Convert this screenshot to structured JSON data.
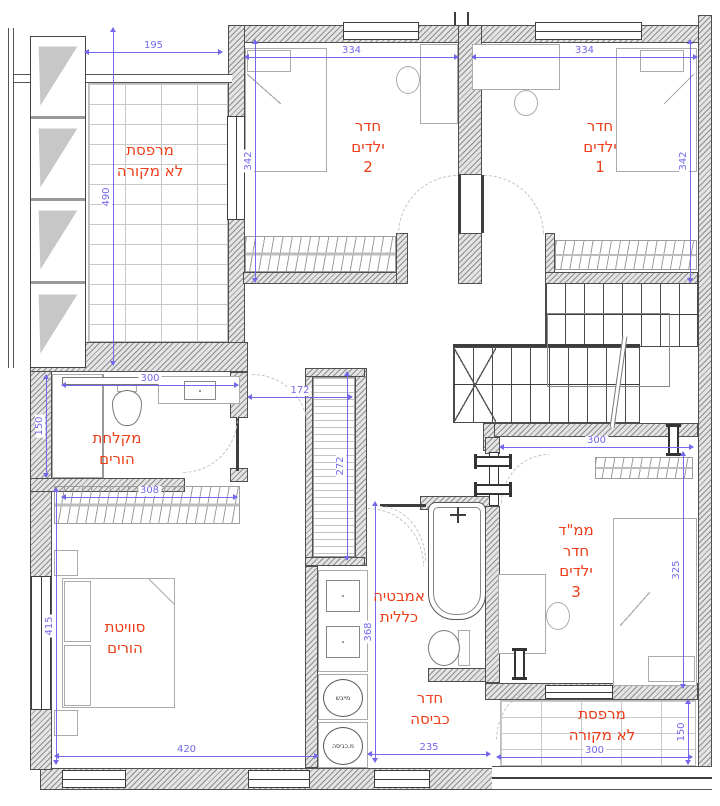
{
  "plan": {
    "title_note": "floor plan",
    "rooms": {
      "balcony_top_left": {
        "label": "מרפסת\nלא מקורה",
        "width": "195",
        "height": "490"
      },
      "kids_room_2": {
        "label": "חדר\nילדים\n2",
        "width": "334",
        "height": "342"
      },
      "kids_room_1": {
        "label": "חדר\nילדים\n1",
        "width": "334",
        "height": "342"
      },
      "parents_shower": {
        "label": "מקלחת\nהורים",
        "width": "300",
        "height": "150"
      },
      "hall_closet": {
        "width": "172",
        "height": "272"
      },
      "parents_wardrobe": {
        "width": "308"
      },
      "parents_suite": {
        "label": "סוויטת\nהורים",
        "width": "420",
        "height": "415"
      },
      "bathroom": {
        "label": "אמבטיה\nכללית",
        "height": "368"
      },
      "mamad_kids_3": {
        "label": "ממ\"ד\nחדר\nילדים\n3",
        "width": "300",
        "height": "325"
      },
      "laundry": {
        "label": "חדר\nכביסה",
        "width": "235"
      },
      "balcony_bottom_right": {
        "label": "מרפסת\nלא מקורה",
        "width": "300",
        "height": "150"
      }
    },
    "appliances": {
      "dryer": "מייבש",
      "washer": "מ.כביסה"
    },
    "colors": {
      "room_label": "#ee3d18",
      "dimension": "#7468ec",
      "wall_outline": "#4f4f4f"
    }
  }
}
